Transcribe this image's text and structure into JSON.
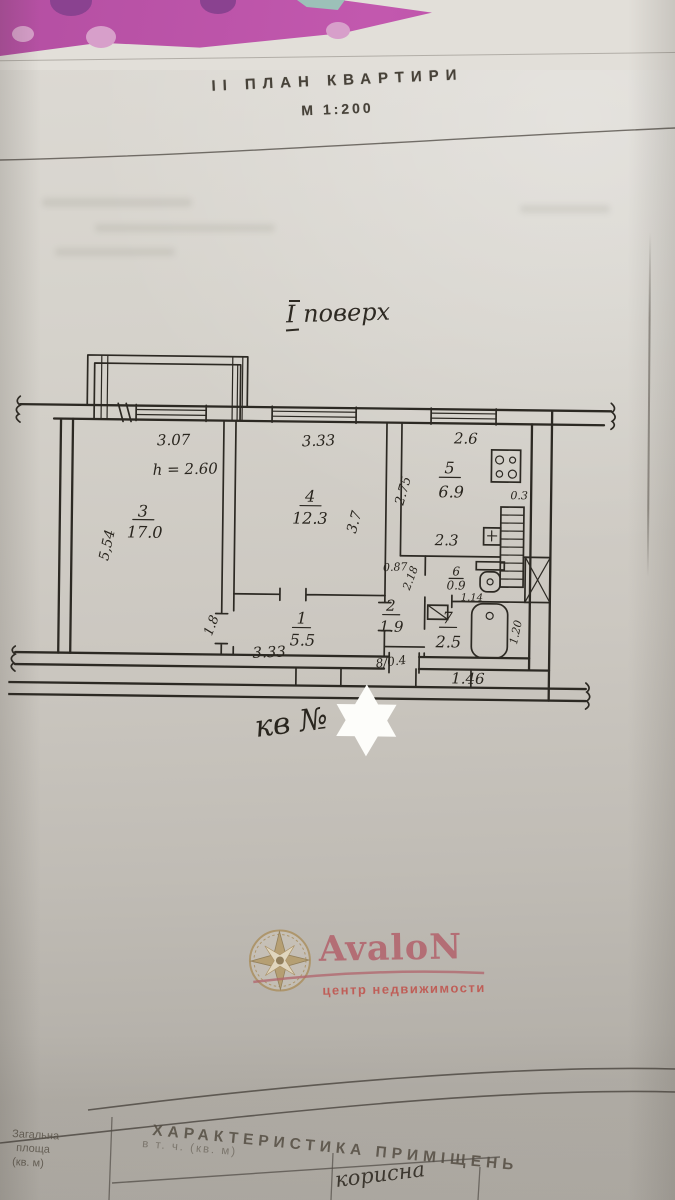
{
  "header": {
    "section_label": "ІІ  ПЛАН  КВАРТИРИ",
    "scale": "М  1:200"
  },
  "plan": {
    "floor_label": "І поверх",
    "apartment_label": "кв №",
    "rooms": [
      {
        "number": "3",
        "area": "17.0"
      },
      {
        "number": "4",
        "area": "12.3"
      },
      {
        "number": "5",
        "area": "6.9"
      },
      {
        "number": "6",
        "area": "0.9"
      },
      {
        "number": "7",
        "area": "2.5"
      },
      {
        "number": "2",
        "area": "1.9"
      },
      {
        "number": "1",
        "area": "5.5"
      }
    ],
    "dims": {
      "room3_width": "3.07",
      "ceiling_height": "h = 2.60",
      "room3_length": "5,54",
      "room4_width": "3.33",
      "room4_length": "3.7",
      "kitchen_width": "2.6",
      "kitchen_length": "2.75",
      "kitchen_bottom": "2.3",
      "vent": "0.3",
      "passage": "0.87",
      "wc_width": "1.14",
      "corridor_length": "2.18",
      "hall_height": "1.8",
      "hall_width": "3.33",
      "bath_width": "1.46",
      "bath_length": "1.20",
      "closet": "8/0.4"
    }
  },
  "watermark": {
    "brand": "AvaloN",
    "tagline": "центр недвижимости"
  },
  "footer": {
    "title": "ХАРАКТЕРИСТИКА  ПРИМІЩЕНЬ",
    "col_total_lines": [
      "Загальна",
      "площа",
      "(кв. м)"
    ],
    "col_incl": "в т. ч.  (кв. м)",
    "col_useful": "корисна"
  }
}
